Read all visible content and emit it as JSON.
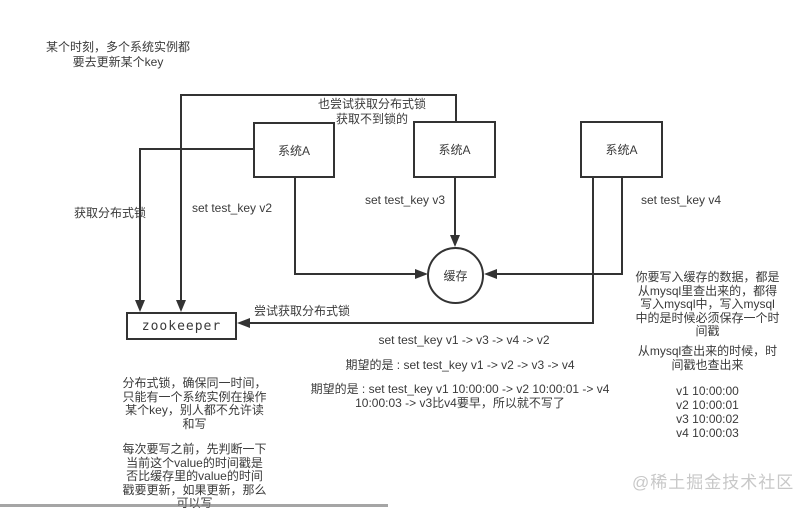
{
  "colors": {
    "background": "#ffffff",
    "line": "#333333",
    "text": "#3a3a3a",
    "watermark": "#c8c8c8"
  },
  "nodes": {
    "system_a_1": "系统A",
    "system_a_2": "系统A",
    "system_a_3": "系统A",
    "zookeeper": "zookeeper",
    "cache": "缓存"
  },
  "edge_labels": {
    "acquire_lock": "获取分布式锁",
    "also_try_lock": "也尝试获取分布式锁\n获取不到锁的",
    "try_acquire_lock": "尝试获取分布式锁",
    "set_v2": "set test_key v2",
    "set_v3": "set test_key v3",
    "set_v4": "set test_key v4"
  },
  "notes": {
    "top_left": "某个时刻，多个系统实例都\n要去更新某个key",
    "actual_order": "set test_key v1 -> v3 -> v4 -> v2",
    "expected_order": "期望的是 : set test_key v1 -> v2 -> v3 -> v4",
    "expected_with_time": "期望的是 : set test_key v1 10:00:00 -> v2 10:00:01 -> v4\n10:00:03 -> v3比v4要早，所以就不写了",
    "lock_explain": "分布式锁，确保同一时间，\n只能有一个系统实例在操作\n某个key，别人都不允许读\n和写",
    "write_check": "每次要写之前，先判断一下\n当前这个value的时间戳是\n否比缓存里的value的时间\n戳要更新，如果更新，那么\n可以写",
    "mysql_write": "你要写入缓存的数据，都是\n从mysql里查出来的，都得\n写入mysql中，写入mysql\n中的是时候必须保存一个时\n间戳",
    "mysql_read": "从mysql查出来的时候，时\n间戳也查出来",
    "timestamps": "v1 10:00:00\nv2 10:00:01\nv3 10:00:02\nv4 10:00:03"
  },
  "watermark": "@稀土掘金技术社区"
}
